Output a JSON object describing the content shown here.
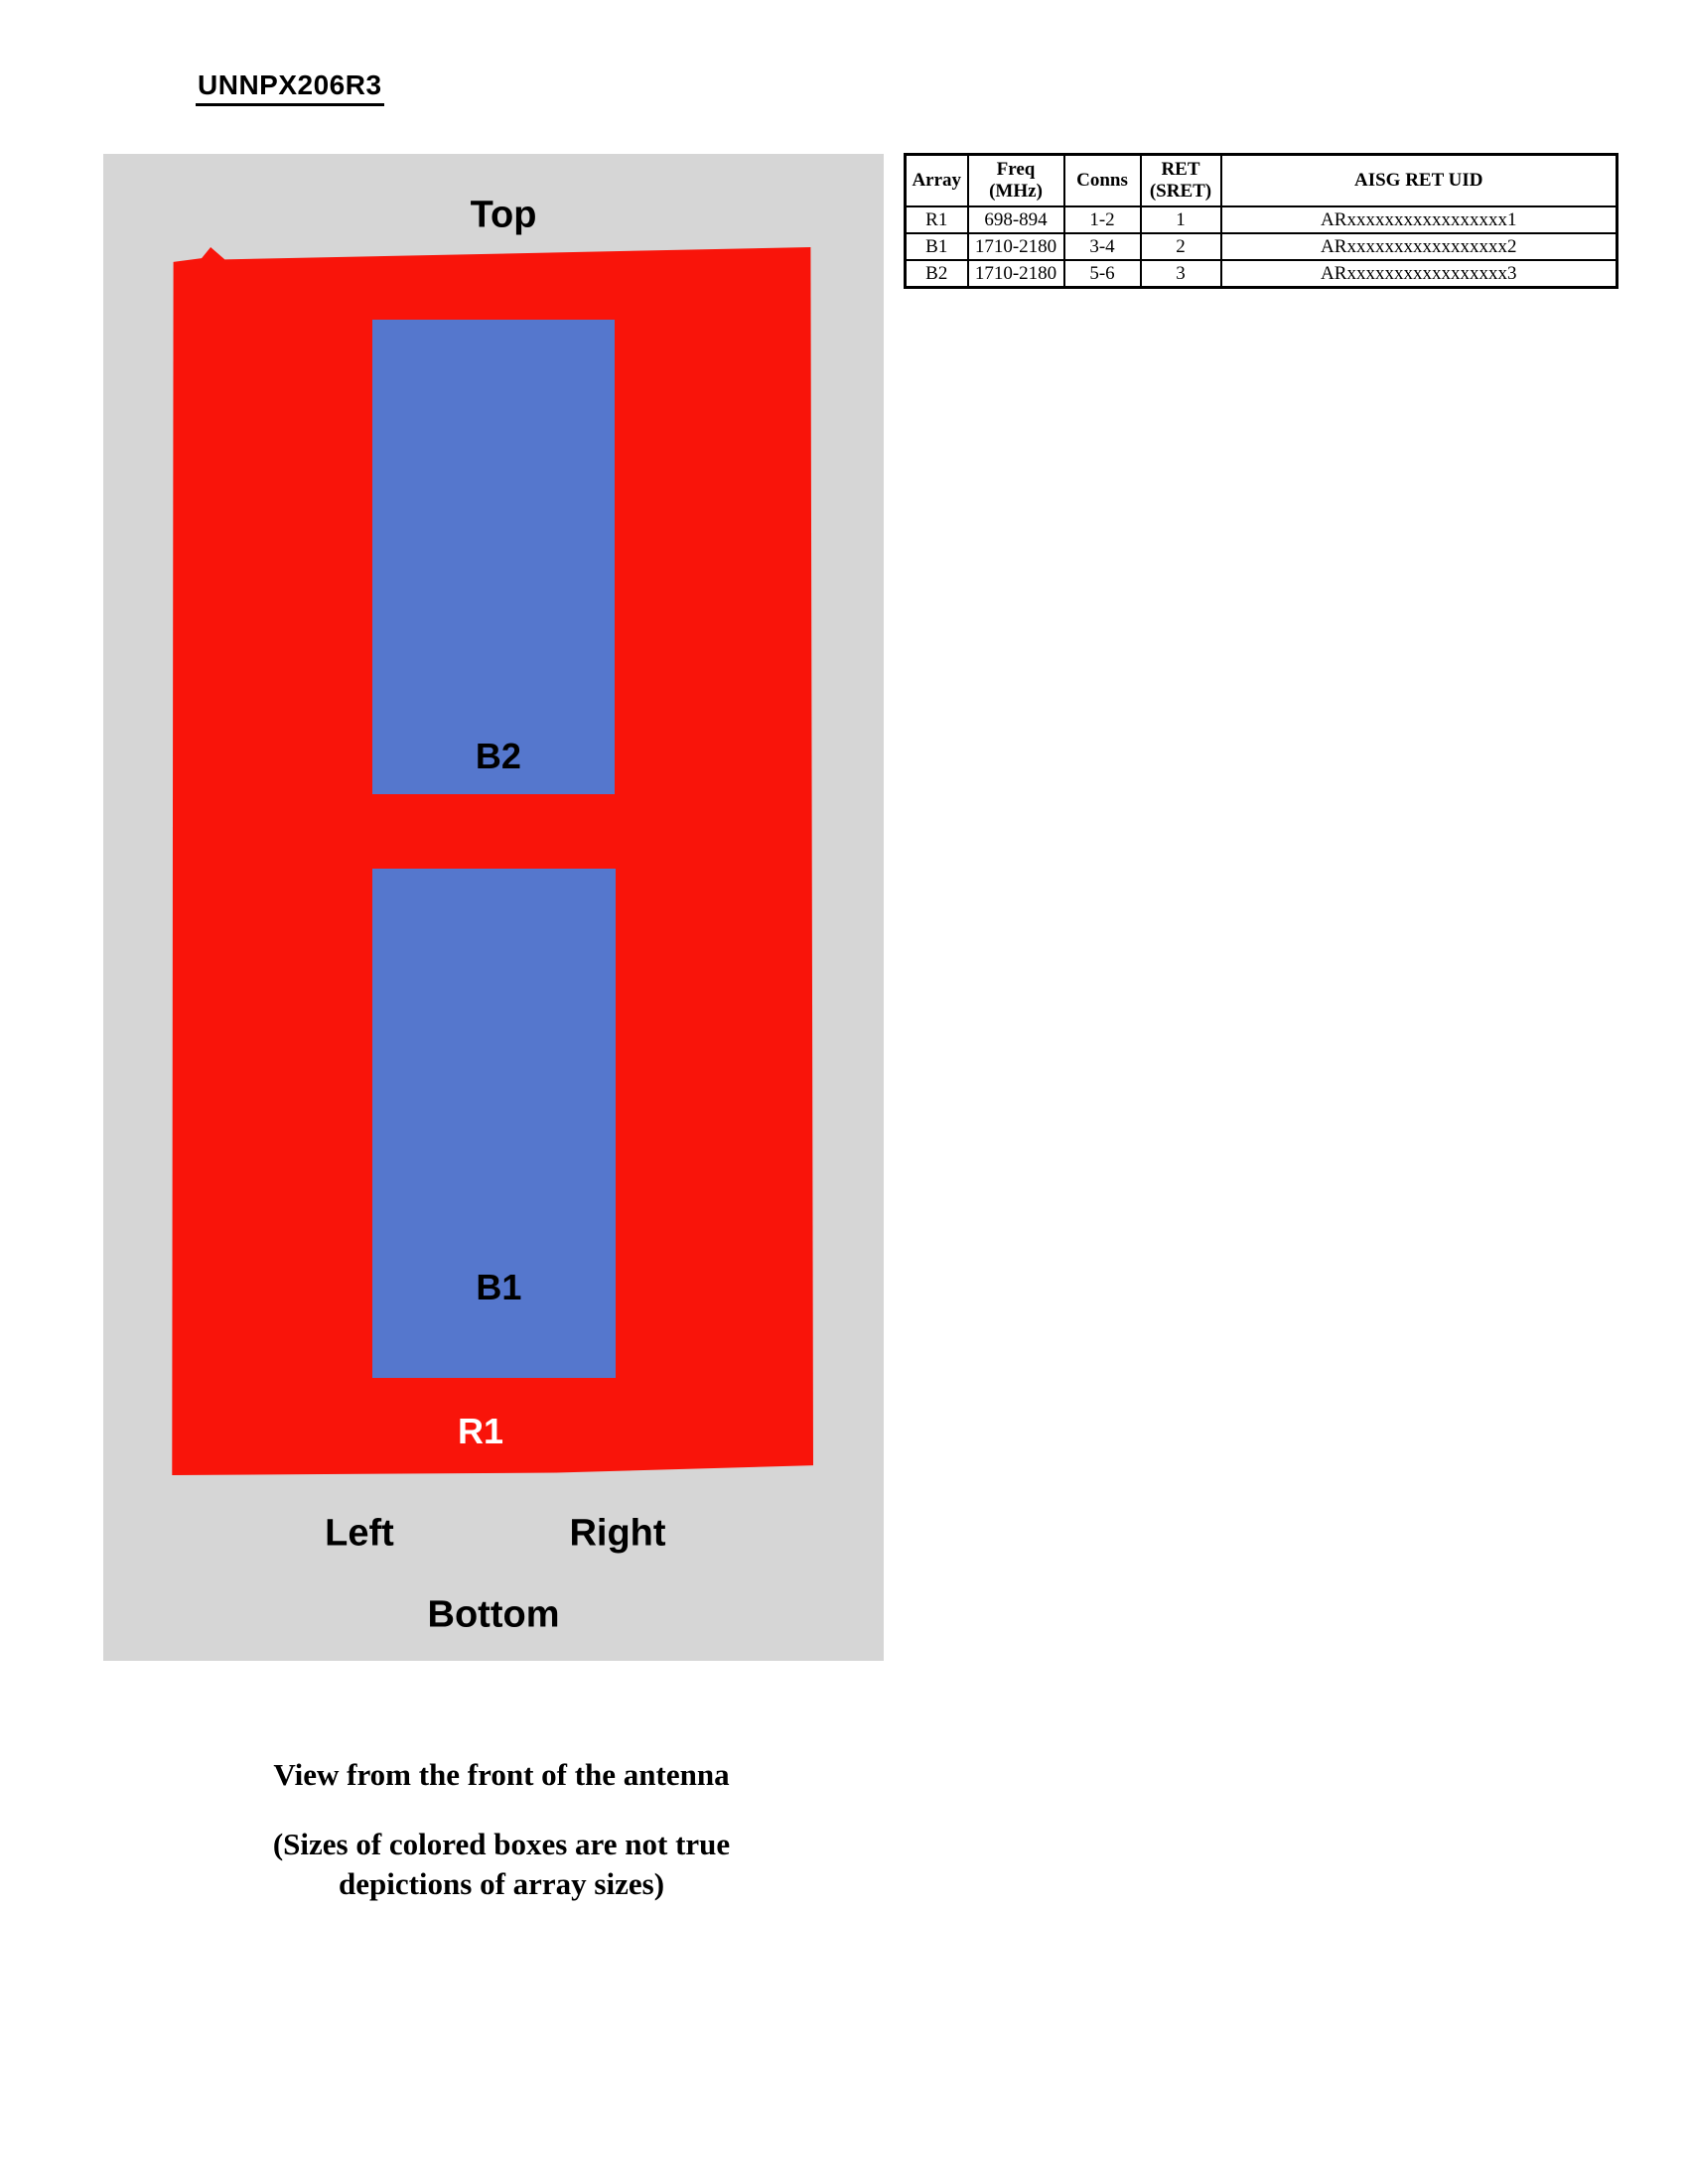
{
  "page": {
    "title": "UNNPX206R3"
  },
  "colors": {
    "panel_gray": "#D6D6D6",
    "radome_red": "#F9140A",
    "array_blue": "#5577CD",
    "r1_label_white": "#FFFFFF"
  },
  "diagram": {
    "orientation": {
      "top": "Top",
      "left": "Left",
      "right": "Right",
      "bottom": "Bottom"
    },
    "arrays": {
      "b2": "B2",
      "b1": "B1",
      "r1": "R1"
    }
  },
  "table": {
    "headers": [
      "Array",
      "Freq\n(MHz)",
      "Conns",
      "RET\n(SRET)",
      "AISG RET UID"
    ],
    "rows": [
      {
        "array": "R1",
        "freq": "698-894",
        "conns": "1-2",
        "ret": "1",
        "uid": "ARxxxxxxxxxxxxxxxxx1"
      },
      {
        "array": "B1",
        "freq": "1710-2180",
        "conns": "3-4",
        "ret": "2",
        "uid": "ARxxxxxxxxxxxxxxxxx2"
      },
      {
        "array": "B2",
        "freq": "1710-2180",
        "conns": "5-6",
        "ret": "3",
        "uid": "ARxxxxxxxxxxxxxxxxx3"
      }
    ]
  },
  "caption": {
    "view_line": "View from the front of the antenna",
    "note_line1": "(Sizes of colored boxes are not true",
    "note_line2": "depictions of array sizes)"
  }
}
